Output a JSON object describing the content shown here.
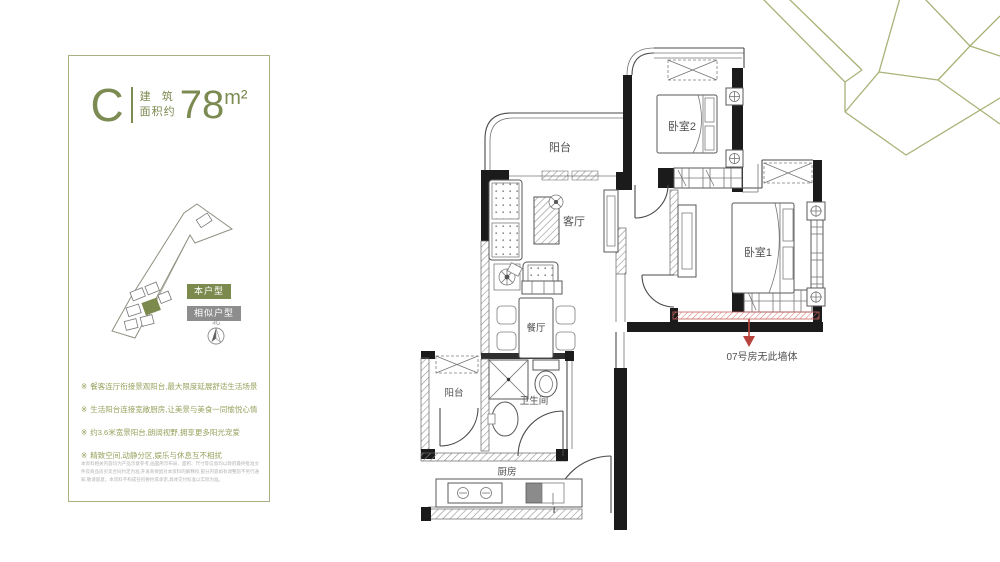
{
  "panel": {
    "unit_label": "C",
    "area_label_line1": "建 筑",
    "area_label_line2": "面积约",
    "area_value": "78",
    "area_unit": "m²",
    "legend": {
      "current": "本户型",
      "similar": "相似户型"
    },
    "north_label": "北",
    "bullet_glyph": "※",
    "features": [
      "餐客连厅衔接景观阳台,最大限度延展舒适生活场景",
      "生活阳台连接宽敞厨房,让美景与美食一同愉悦心情",
      "约3.6米宽景阳台,朗阔视野,拥享更多阳光宠爱",
      "精致空间,动静分区,娱乐与休息互不相扰"
    ],
    "disclaimer": "本资料相关内容均为产品示意参考,画面所示布局、面积、尺寸等信息均以政府最终批准文件及商品房买卖合同约定为准;开发商保留对本资料的解释权,部分内容如有调整恕不另行通知,敬请留意。本资料不构成任何要约或承诺,具体交付标准以实际为准。"
  },
  "floorplan": {
    "rooms": {
      "balcony_top": "阳台",
      "bedroom2": "卧室2",
      "bedroom1": "卧室1",
      "living": "客厅",
      "dining": "餐厅",
      "balcony_bottom": "阳台",
      "bathroom": "卫生间",
      "kitchen": "厨房"
    },
    "annotation": "07号房无此墙体"
  },
  "colors": {
    "accent_olive": "#7c8b51",
    "legend_green": "#7d8a4e",
    "legend_gray": "#8d8d8d",
    "annotation_red": "#b8433c",
    "wall_black": "#1b1b1b"
  }
}
